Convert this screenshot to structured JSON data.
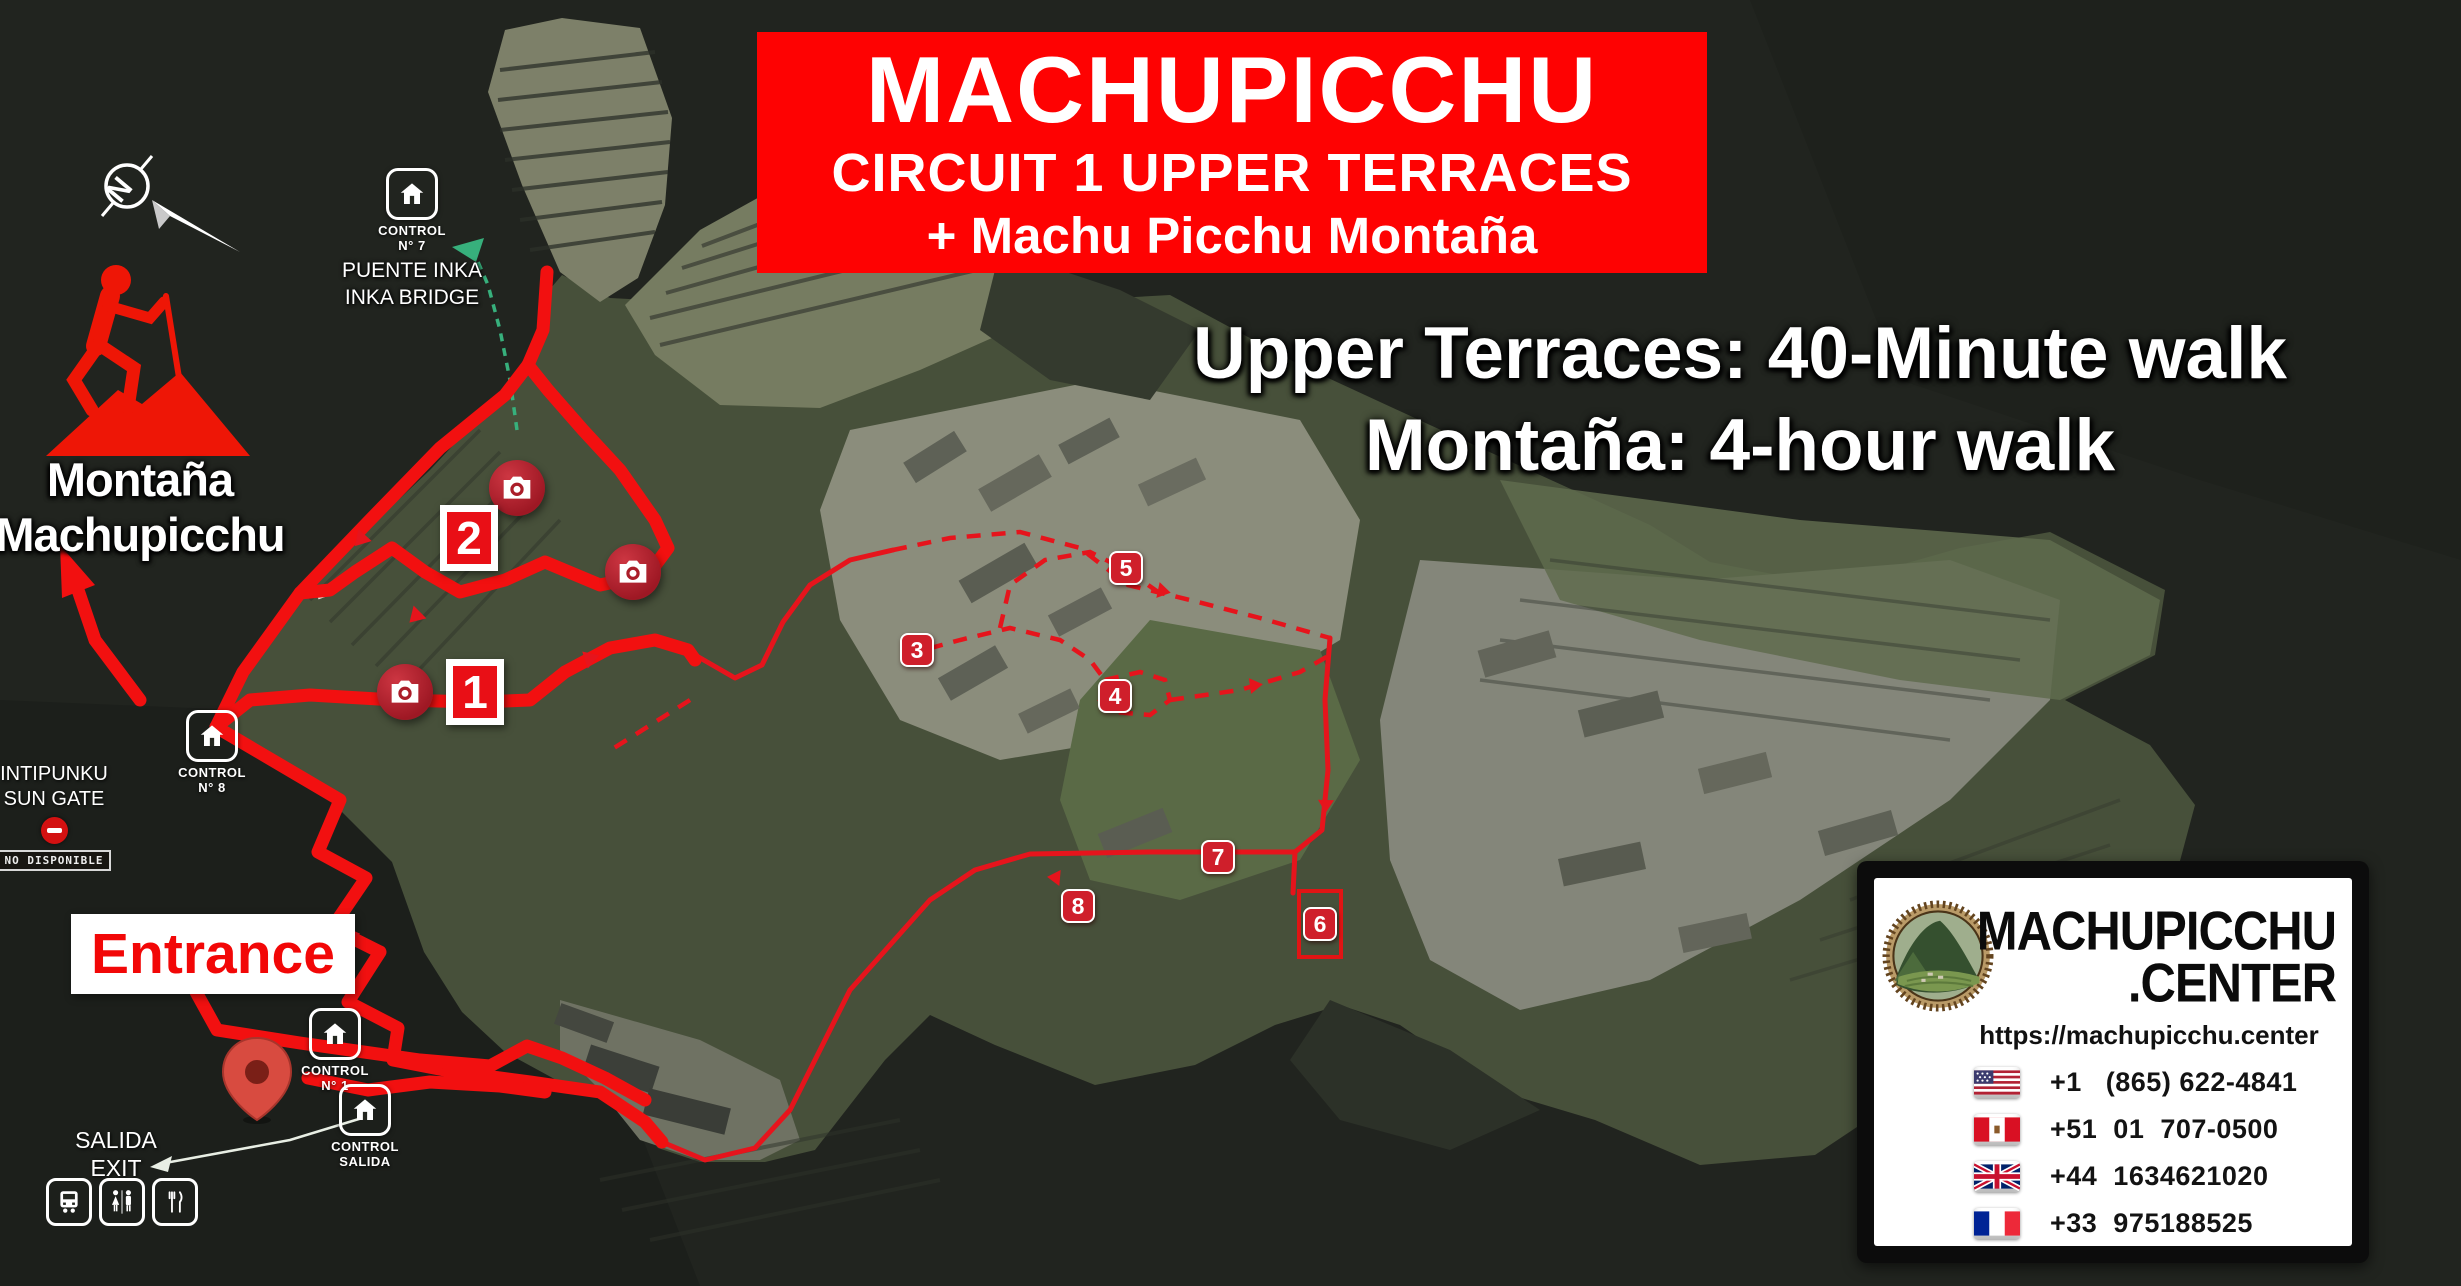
{
  "banner": {
    "line1": "MACHUPICCHU",
    "line2": "CIRCUIT 1 UPPER TERRACES",
    "line3": "+ Machu Picchu Montaña"
  },
  "subtitle": {
    "line1": "Upper Terraces: 40-Minute walk",
    "line2": "Montaña: 4-hour walk"
  },
  "compass": {
    "letter": "N"
  },
  "montana": {
    "line1": "Montaña",
    "line2": "Machupicchu"
  },
  "puente_inka": {
    "line1": "PUENTE INKA",
    "line2": "INKA BRIDGE"
  },
  "intipunku": {
    "line1": "INTIPUNKU",
    "line2": "SUN GATE",
    "badge": "NO DISPONIBLE"
  },
  "controls": {
    "bridge": {
      "label": "CONTROL",
      "number": "N° 7"
    },
    "gate8": {
      "label": "CONTROL",
      "number": "N° 8"
    },
    "entrance1": {
      "label": "CONTROL",
      "number": "N° 1"
    },
    "salida": {
      "label": "CONTROL",
      "number": "SALIDA"
    }
  },
  "entrance": {
    "label": "Entrance"
  },
  "salida_exit": {
    "line1": "SALIDA",
    "line2": "EXIT"
  },
  "markers": {
    "m1": "1",
    "m2": "2",
    "m3": "3",
    "m4": "4",
    "m5": "5",
    "m6": "6",
    "m7": "7",
    "m8": "8"
  },
  "info_card": {
    "brand_top": "MACHUPICCHU",
    "brand_bottom": ".CENTER",
    "url": "https://machupicchu.center",
    "phones": [
      {
        "country": "USA",
        "number": "+1   (865) 622-4841"
      },
      {
        "country": "Peru",
        "number": "+51  01  707-0500"
      },
      {
        "country": "UK",
        "number": "+44  1634621020"
      },
      {
        "country": "France",
        "number": "+33  975188525"
      }
    ]
  },
  "colors": {
    "banner_red": "#fe0202",
    "route_red": "#f21010",
    "marker_red": "#cf1f2b",
    "trail_green": "#37b07c"
  }
}
